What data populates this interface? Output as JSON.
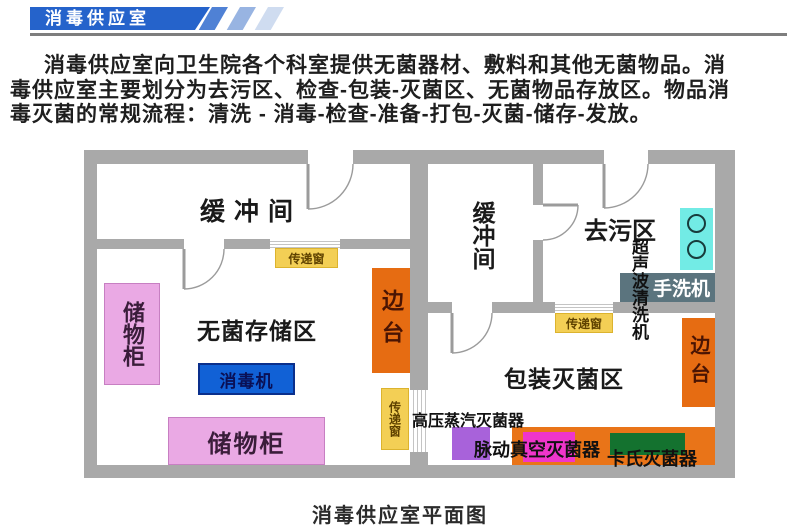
{
  "banner": {
    "title": "消毒供应室"
  },
  "intro": {
    "line1": "消毒供应室向卫生院各个科室提供无菌器材、敷料和其他无菌物品。消",
    "line2": "毒供应室主要划分为去污区、检查-包装-灭菌区、无菌物品存放区。物品消",
    "line3": "毒灭菌的常规流程：清洗 - 消毒-检查-准备-打包-灭菌-储存-发放。"
  },
  "plan": {
    "room_labels": {
      "buffer_left": "缓冲间",
      "buffer_middle": "缓冲间",
      "decontamination": "去污区",
      "sterile_storage": "无菌存储区",
      "packing_sterilization": "包装灭菌区"
    },
    "equipment": {
      "cabinet_vertical": "储物柜",
      "cabinet_horizontal": "储物柜",
      "disinfector": "消毒机",
      "side_table_left": "边台",
      "side_table_right": "边台",
      "pass_window_top": "传递窗",
      "pass_window_right": "传递窗",
      "pass_window_middle": "传递窗",
      "ultrasonic_cleaner": "超声波清洗机",
      "hand_washer": "手洗机",
      "autoclave": "高压蒸汽灭菌器",
      "pulse_vacuum_sterilizer": "脉动真空灭菌器",
      "cassette_sterilizer": "卡氏灭菌器"
    }
  },
  "caption": "消毒供应室平面图",
  "colors": {
    "banner_blue": "#2563cb",
    "stripe1": "#4f81d5",
    "stripe2": "#98b4e2",
    "stripe3": "#cfdcf0",
    "wall": "#a9a9a9",
    "pink": "#eaa9e4",
    "pink_border": "#c77fc2",
    "blue_box": "#1161d6",
    "blue_box_border": "#0a2f8c",
    "orange": "#e66c12",
    "big_orange": "#e97418",
    "yellow": "#f3cf55",
    "yellow_border": "#dcb32e",
    "cyan": "#72ebe5",
    "slate": "#5b747e",
    "purple": "#a862da",
    "magenta": "#ef35cb",
    "green": "#14722f"
  }
}
